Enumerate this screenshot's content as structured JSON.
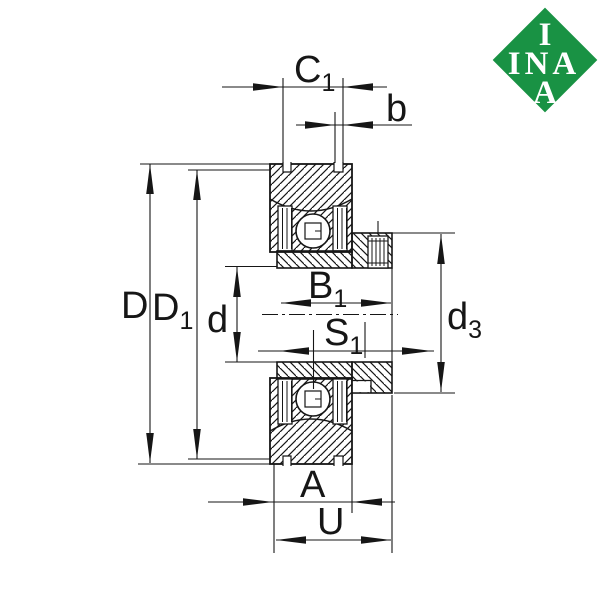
{
  "colors": {
    "ink": "#161616",
    "background": "#ffffff"
  },
  "logo": {
    "color": "#199244",
    "rows": [
      "I",
      "INA",
      "A"
    ]
  },
  "dimensions": [
    {
      "id": "C1",
      "main": "C",
      "sub": "1"
    },
    {
      "id": "b",
      "main": "b",
      "sub": ""
    },
    {
      "id": "D",
      "main": "D",
      "sub": ""
    },
    {
      "id": "D1",
      "main": "D",
      "sub": "1"
    },
    {
      "id": "d",
      "main": "d",
      "sub": ""
    },
    {
      "id": "B1",
      "main": "B",
      "sub": "1"
    },
    {
      "id": "S1",
      "main": "S",
      "sub": "1"
    },
    {
      "id": "d3",
      "main": "d",
      "sub": "3"
    },
    {
      "id": "A",
      "main": "A",
      "sub": ""
    },
    {
      "id": "U",
      "main": "U",
      "sub": ""
    }
  ]
}
